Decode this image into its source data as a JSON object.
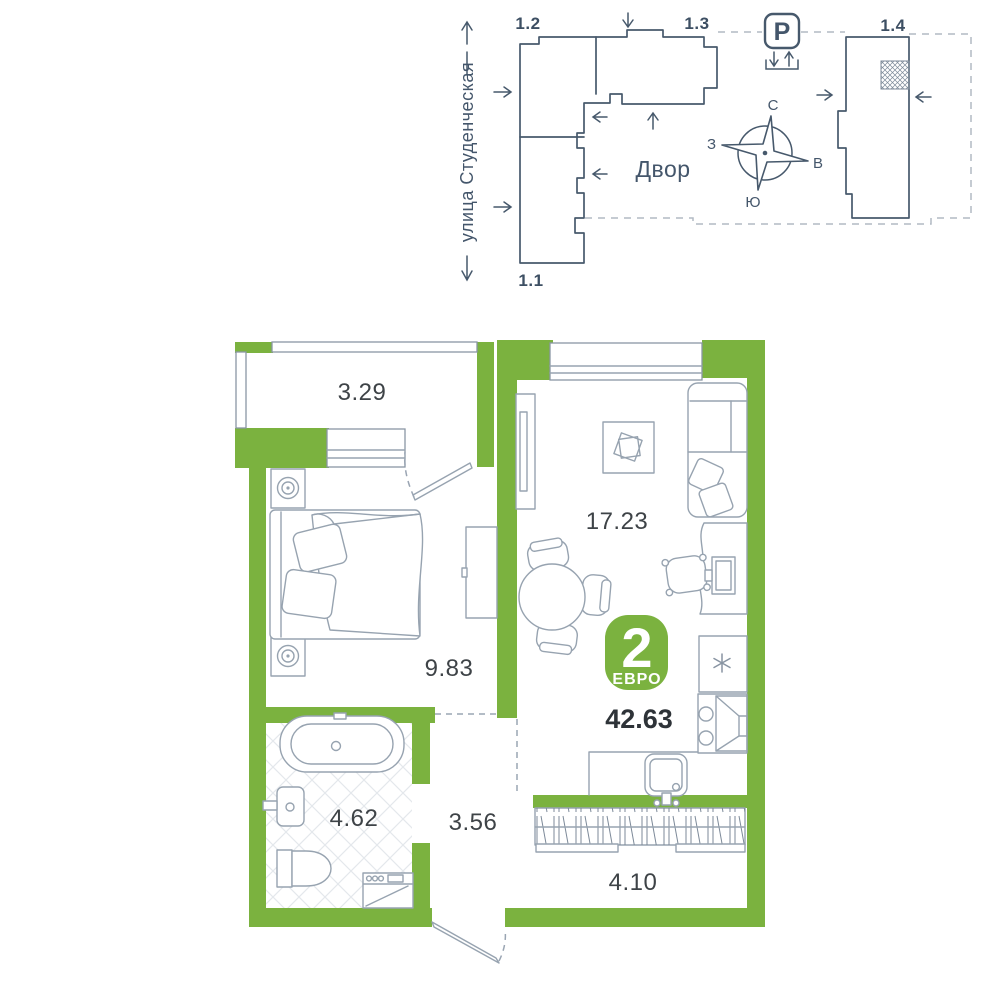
{
  "colors": {
    "wall_green": "#7BB23F",
    "line_slate": "#47596C",
    "furniture_gray": "#97A3B0"
  },
  "site_plan": {
    "street_label": "улица Студенческая",
    "courtyard_label": "Двор",
    "parking_symbol": "P",
    "buildings": [
      {
        "id": "1.2"
      },
      {
        "id": "1.3"
      },
      {
        "id": "1.1"
      },
      {
        "id": "1.4"
      }
    ],
    "compass": {
      "north": "С",
      "south": "Ю",
      "west": "З",
      "east": "В"
    },
    "icons": {
      "parking": "parking-icon",
      "compass": "compass-rose-icon",
      "unit_location": "unit-location-hatch"
    }
  },
  "apartment": {
    "badge": {
      "rooms_count": "2",
      "format_label": "ЕВРО"
    },
    "total_area": "42.63",
    "rooms": [
      {
        "name": "balcony",
        "area": "3.29"
      },
      {
        "name": "living-kitchen",
        "area": "17.23"
      },
      {
        "name": "bedroom",
        "area": "9.83"
      },
      {
        "name": "bathroom",
        "area": "4.62"
      },
      {
        "name": "hallway",
        "area": "3.56"
      },
      {
        "name": "loggia",
        "area": "4.10"
      }
    ],
    "icons": {
      "fridge": "snowflake-icon"
    }
  }
}
